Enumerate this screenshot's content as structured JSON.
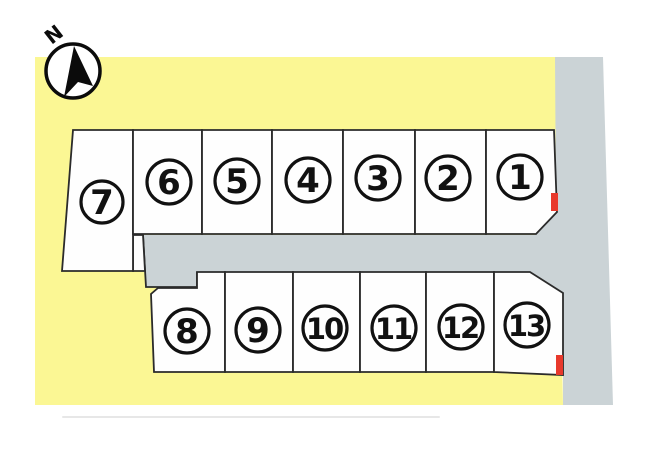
{
  "compass": {
    "label": "N"
  },
  "colors": {
    "background": "#ffffff",
    "land": "#fbf794",
    "road": "#cbd3d6",
    "lot_fill": "#fefefe",
    "outline": "#2b2b2b",
    "number_ink": "#111111",
    "sale_marker_red": "#e8392c",
    "artifact_line_gray": "#d4d4d4"
  },
  "lots": [
    {
      "label": "1"
    },
    {
      "label": "2"
    },
    {
      "label": "3"
    },
    {
      "label": "4"
    },
    {
      "label": "5"
    },
    {
      "label": "6"
    },
    {
      "label": "7"
    },
    {
      "label": "8"
    },
    {
      "label": "9"
    },
    {
      "label": "10"
    },
    {
      "label": "11"
    },
    {
      "label": "12"
    },
    {
      "label": "13"
    }
  ],
  "red_markers_on_lots": [
    "1",
    "13"
  ]
}
